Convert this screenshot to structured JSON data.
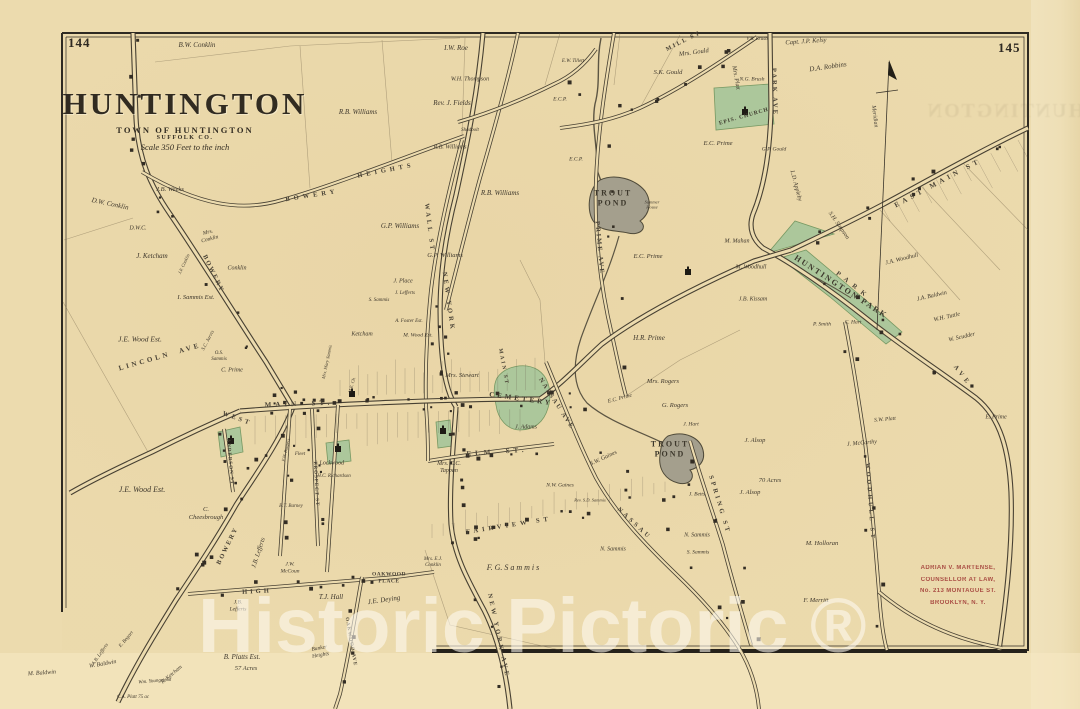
{
  "page": {
    "left_number": "144",
    "right_number": "145"
  },
  "title": {
    "main": "HUNTINGTON",
    "sub1": "TOWN OF HUNTINGTON",
    "sub2": "SUFFOLK CO.",
    "scale": "Scale 350 Feet to the inch"
  },
  "compass": {
    "label": "Meridian"
  },
  "watermark": {
    "text": "Historic Pictoric ®"
  },
  "stamp": {
    "color": "#a3403a",
    "lines": [
      "ADRIAN V. MARTENSE,",
      "COUNSELLOR AT LAW,",
      "No. 213 MONTAGUE ST.",
      "BROOKLYN, N. Y."
    ]
  },
  "colors": {
    "paper": "#ecdbae",
    "ink": "#3f382d",
    "road_casing": "#474032",
    "park_green": "#a9c79b",
    "park_green_edge": "#71955f",
    "pond_gray": "#a49f8d",
    "stream": "#5c5543",
    "stamp_red": "#a3403a"
  },
  "map_labels": {
    "roads": [
      {
        "t": "MAIN  ST.",
        "x": 299,
        "y": 404,
        "r": -2,
        "s": 7,
        "ls": 4
      },
      {
        "t": "MAIN ST",
        "x": 503,
        "y": 367,
        "r": 80,
        "s": 5.5,
        "ls": 2
      },
      {
        "t": "EAST MAIN ST",
        "x": 938,
        "y": 183,
        "r": -28,
        "s": 7,
        "ls": 4
      },
      {
        "t": "ELM  ST.",
        "x": 497,
        "y": 452,
        "r": -4,
        "s": 7,
        "ls": 4
      },
      {
        "t": "WALL ST",
        "x": 429,
        "y": 228,
        "r": 83,
        "s": 6.5,
        "ls": 3
      },
      {
        "t": "NEW YORK",
        "x": 448,
        "y": 302,
        "r": 82,
        "s": 6.5,
        "ls": 3
      },
      {
        "t": "NEW YORK AVE",
        "x": 498,
        "y": 636,
        "r": 78,
        "s": 6.5,
        "ls": 3
      },
      {
        "t": "PRIME AVE",
        "x": 599,
        "y": 248,
        "r": 85,
        "s": 6.5,
        "ls": 2
      },
      {
        "t": "PARK AVE",
        "x": 774,
        "y": 92,
        "r": 88,
        "s": 6.5,
        "ls": 2
      },
      {
        "t": "PARK",
        "x": 853,
        "y": 286,
        "r": 38,
        "s": 6.5,
        "ls": 6
      },
      {
        "t": "AVE",
        "x": 962,
        "y": 376,
        "r": 52,
        "s": 6.5,
        "ls": 4
      },
      {
        "t": "MILL ST",
        "x": 684,
        "y": 42,
        "r": -27,
        "s": 6,
        "ls": 2
      },
      {
        "t": "NASSAU AVE",
        "x": 556,
        "y": 404,
        "r": 57,
        "s": 6.5,
        "ls": 2
      },
      {
        "t": "NASSAU",
        "x": 634,
        "y": 524,
        "r": 43,
        "s": 6.5,
        "ls": 3
      },
      {
        "t": "FAIRVIEW ST",
        "x": 509,
        "y": 526,
        "r": -9,
        "s": 6.5,
        "ls": 4
      },
      {
        "t": "SPRING ST",
        "x": 719,
        "y": 505,
        "r": 73,
        "s": 6.5,
        "ls": 3
      },
      {
        "t": "WOODHULL ST",
        "x": 869,
        "y": 502,
        "r": 86,
        "s": 6,
        "ls": 3
      },
      {
        "t": "HIGH",
        "x": 257,
        "y": 592,
        "r": -3,
        "s": 6.5,
        "ls": 3
      },
      {
        "t": "BOWERY",
        "x": 312,
        "y": 196,
        "r": -9,
        "s": 6.5,
        "ls": 4
      },
      {
        "t": "HEIGHTS",
        "x": 386,
        "y": 171,
        "r": -11,
        "s": 6.5,
        "ls": 4
      },
      {
        "t": "BOWERY",
        "x": 213,
        "y": 274,
        "r": 64,
        "s": 6.5,
        "ls": 2
      },
      {
        "t": "BOWERY",
        "x": 228,
        "y": 546,
        "r": -64,
        "s": 6.5,
        "ls": 2
      },
      {
        "t": "LINCOLN  AVE",
        "x": 160,
        "y": 357,
        "r": -16,
        "s": 7,
        "ls": 3
      },
      {
        "t": "WEST",
        "x": 237,
        "y": 419,
        "r": 20,
        "s": 6.5,
        "ls": 3
      },
      {
        "t": "ANDERSON ST",
        "x": 229,
        "y": 462,
        "r": 85,
        "s": 5,
        "ls": 1
      },
      {
        "t": "PROSPECT ST",
        "x": 315,
        "y": 484,
        "r": 87,
        "s": 5,
        "ls": 1
      },
      {
        "t": "OAKWOOD AVE",
        "x": 350,
        "y": 642,
        "r": 80,
        "s": 5,
        "ls": 1
      },
      {
        "t": "OAKWOOD\nPLACE",
        "x": 389,
        "y": 578,
        "r": 0,
        "s": 5.5,
        "ls": 0.5
      }
    ],
    "features": [
      {
        "t": "TROUT\nPOND",
        "x": 613,
        "y": 198,
        "r": 0,
        "s": 8,
        "ls": 2
      },
      {
        "t": "TROUT\nPOND",
        "x": 670,
        "y": 449,
        "r": 0,
        "s": 8,
        "ls": 2
      },
      {
        "t": "CEMETERY",
        "x": 521,
        "y": 399,
        "r": 8,
        "s": 7,
        "ls": 3
      },
      {
        "t": "EPIS. CHURCH",
        "x": 744,
        "y": 117,
        "r": -16,
        "s": 5.5,
        "ls": 1
      },
      {
        "t": "HUNTINGTON PARK",
        "x": 841,
        "y": 287,
        "r": 33,
        "s": 8,
        "ls": 2
      }
    ],
    "owners": [
      {
        "t": "B.W. Conklin",
        "x": 197,
        "y": 45,
        "r": 0,
        "s": 7
      },
      {
        "t": "I.W. Roe",
        "x": 456,
        "y": 48,
        "r": 0,
        "s": 7
      },
      {
        "t": "W.H. Thompson",
        "x": 470,
        "y": 80,
        "r": 0,
        "s": 6
      },
      {
        "t": "Rev. J. Fields",
        "x": 452,
        "y": 103,
        "r": 0,
        "s": 7
      },
      {
        "t": "Mrs. Gould",
        "x": 694,
        "y": 53,
        "r": -8,
        "s": 6.5
      },
      {
        "t": "S.K. Gould",
        "x": 668,
        "y": 73,
        "r": 0,
        "s": 6.5
      },
      {
        "t": "Capt. J.P. Kelsy",
        "x": 806,
        "y": 42,
        "r": -4,
        "s": 6.5
      },
      {
        "t": "V.B. Brush",
        "x": 757,
        "y": 40,
        "r": 0,
        "s": 5
      },
      {
        "t": "D.A. Robbins",
        "x": 828,
        "y": 67,
        "r": -8,
        "s": 7
      },
      {
        "t": "E.W. Tillett",
        "x": 573,
        "y": 62,
        "r": 0,
        "s": 5
      },
      {
        "t": "N.G. Brush",
        "x": 752,
        "y": 80,
        "r": 0,
        "s": 5.5
      },
      {
        "t": "Mrs. Platt",
        "x": 735,
        "y": 78,
        "r": 80,
        "s": 6
      },
      {
        "t": "E.C. Prime",
        "x": 718,
        "y": 144,
        "r": 0,
        "s": 6.5
      },
      {
        "t": "G.P. Gould",
        "x": 774,
        "y": 150,
        "r": 0,
        "s": 5.5
      },
      {
        "t": "L.D. Appleby",
        "x": 795,
        "y": 186,
        "r": 75,
        "s": 6
      },
      {
        "t": "S.H. Simpson",
        "x": 838,
        "y": 226,
        "r": 55,
        "s": 6
      },
      {
        "t": "E.C.P.",
        "x": 560,
        "y": 100,
        "r": 0,
        "s": 5.5
      },
      {
        "t": "E.C.P.",
        "x": 576,
        "y": 160,
        "r": 0,
        "s": 5.5
      },
      {
        "t": "E.C. Prime",
        "x": 648,
        "y": 257,
        "r": 0,
        "s": 6.5
      },
      {
        "t": "M. Mahan",
        "x": 737,
        "y": 242,
        "r": 0,
        "s": 6
      },
      {
        "t": "M. Woodhull",
        "x": 751,
        "y": 268,
        "r": 0,
        "s": 6
      },
      {
        "t": "J.B. Kissam",
        "x": 753,
        "y": 300,
        "r": 0,
        "s": 6
      },
      {
        "t": "R.B. Williams",
        "x": 358,
        "y": 112,
        "r": 0,
        "s": 7
      },
      {
        "t": "R.B. Williams",
        "x": 450,
        "y": 148,
        "r": 0,
        "s": 6
      },
      {
        "t": "R.B. Williams",
        "x": 500,
        "y": 193,
        "r": 0,
        "s": 7
      },
      {
        "t": "G.P. Williams",
        "x": 400,
        "y": 226,
        "r": 0,
        "s": 7
      },
      {
        "t": "G.P. Williams",
        "x": 445,
        "y": 256,
        "r": 0,
        "s": 6.5
      },
      {
        "t": "Shadbolt",
        "x": 470,
        "y": 131,
        "r": 0,
        "s": 5
      },
      {
        "t": "D.W. Conklin",
        "x": 110,
        "y": 204,
        "r": 12,
        "s": 7
      },
      {
        "t": "J.B. Weeks",
        "x": 170,
        "y": 190,
        "r": 0,
        "s": 6.5
      },
      {
        "t": "D.W.C.",
        "x": 138,
        "y": 229,
        "r": 0,
        "s": 6
      },
      {
        "t": "J. Ketcham",
        "x": 152,
        "y": 256,
        "r": 0,
        "s": 7
      },
      {
        "t": "Mrs.\nConklin",
        "x": 209,
        "y": 236,
        "r": -15,
        "s": 5.5
      },
      {
        "t": "J.F. Conklin",
        "x": 184,
        "y": 264,
        "r": -65,
        "s": 4.5
      },
      {
        "t": "Conklin",
        "x": 237,
        "y": 269,
        "r": 0,
        "s": 6
      },
      {
        "t": "I. Sammis Est.",
        "x": 196,
        "y": 298,
        "r": 0,
        "s": 6.5
      },
      {
        "t": "J.E. Wood Est.",
        "x": 140,
        "y": 339,
        "r": 0,
        "s": 7.5
      },
      {
        "t": "S.C. Jarvis",
        "x": 209,
        "y": 341,
        "r": -62,
        "s": 5
      },
      {
        "t": "O.S.\nSammis",
        "x": 219,
        "y": 357,
        "r": 0,
        "s": 5
      },
      {
        "t": "C. Prime",
        "x": 232,
        "y": 371,
        "r": 0,
        "s": 6
      },
      {
        "t": "J.E. Wood Est.",
        "x": 142,
        "y": 490,
        "r": 0,
        "s": 8
      },
      {
        "t": "C.\nCheesbrough",
        "x": 206,
        "y": 514,
        "r": 0,
        "s": 6.5
      },
      {
        "t": "J.B. Lefferts",
        "x": 259,
        "y": 553,
        "r": -72,
        "s": 6.5
      },
      {
        "t": "J.W.\nMcCoun",
        "x": 290,
        "y": 568,
        "r": 0,
        "s": 5.5
      },
      {
        "t": "Wm. Youngstead",
        "x": 155,
        "y": 682,
        "r": -5,
        "s": 5
      },
      {
        "t": "W. Baldwin",
        "x": 103,
        "y": 665,
        "r": -10,
        "s": 6
      },
      {
        "t": "M. Baldwin",
        "x": 42,
        "y": 674,
        "r": -4,
        "s": 6
      },
      {
        "t": "R. Ketcham",
        "x": 172,
        "y": 675,
        "r": -40,
        "s": 5.5
      },
      {
        "t": "E. Bogart",
        "x": 127,
        "y": 640,
        "r": -50,
        "s": 5
      },
      {
        "t": "A.B. Lefferts",
        "x": 101,
        "y": 655,
        "r": -55,
        "s": 5
      },
      {
        "t": "B. Platts Est.",
        "x": 242,
        "y": 657,
        "r": 0,
        "s": 7
      },
      {
        "t": "C.A. Platt 75 ac",
        "x": 133,
        "y": 698,
        "r": 0,
        "s": 5
      },
      {
        "t": "T.J. Hall",
        "x": 331,
        "y": 597,
        "r": 0,
        "s": 7
      },
      {
        "t": "J.E. Deying",
        "x": 384,
        "y": 600,
        "r": -8,
        "s": 7
      },
      {
        "t": "Bunker\nHeights",
        "x": 320,
        "y": 652,
        "r": -10,
        "s": 5.5
      },
      {
        "t": "J.B.\nLefferts",
        "x": 238,
        "y": 606,
        "r": 0,
        "s": 5.5
      },
      {
        "t": "Mrs. Mary Sammis",
        "x": 327,
        "y": 362,
        "r": -78,
        "s": 4.5
      },
      {
        "t": "M.E. Ch.",
        "x": 352,
        "y": 385,
        "r": -75,
        "s": 4.5
      },
      {
        "t": "Ketcham",
        "x": 362,
        "y": 335,
        "r": 0,
        "s": 6
      },
      {
        "t": "M. Wood Est.",
        "x": 418,
        "y": 336,
        "r": 0,
        "s": 5.5
      },
      {
        "t": "J. Place",
        "x": 403,
        "y": 282,
        "r": 0,
        "s": 6
      },
      {
        "t": "J. Lefferts",
        "x": 405,
        "y": 294,
        "r": 0,
        "s": 5
      },
      {
        "t": "S. Sammis",
        "x": 379,
        "y": 301,
        "r": 0,
        "s": 5
      },
      {
        "t": "A. Foster Est.",
        "x": 409,
        "y": 322,
        "r": 0,
        "s": 5
      },
      {
        "t": "Fleet",
        "x": 300,
        "y": 455,
        "r": 0,
        "s": 5
      },
      {
        "t": "F.W. Burgess",
        "x": 286,
        "y": 450,
        "r": -76,
        "s": 4.5
      },
      {
        "t": "J. Lockwood",
        "x": 329,
        "y": 464,
        "r": 0,
        "s": 6
      },
      {
        "t": "H.C. Richardson",
        "x": 334,
        "y": 477,
        "r": 0,
        "s": 5
      },
      {
        "t": "B.T. Barney",
        "x": 291,
        "y": 507,
        "r": 0,
        "s": 5
      },
      {
        "t": "Mrs. Stewart",
        "x": 462,
        "y": 376,
        "r": 0,
        "s": 6.5
      },
      {
        "t": "J. Adams",
        "x": 526,
        "y": 428,
        "r": 0,
        "s": 6
      },
      {
        "t": "Mrs. C.C.\nTappan",
        "x": 449,
        "y": 468,
        "r": 0,
        "s": 6
      },
      {
        "t": "S.W. Gaines",
        "x": 604,
        "y": 459,
        "r": -25,
        "s": 6
      },
      {
        "t": "N.W. Gaines",
        "x": 560,
        "y": 486,
        "r": 0,
        "s": 5.5
      },
      {
        "t": "Rev. S.D. Sammis",
        "x": 590,
        "y": 500,
        "r": 0,
        "s": 4.5
      },
      {
        "t": "F. G. S a m m i s",
        "x": 513,
        "y": 568,
        "r": 0,
        "s": 8
      },
      {
        "t": "N. Sammis",
        "x": 613,
        "y": 550,
        "r": 0,
        "s": 6
      },
      {
        "t": "N. Sammis",
        "x": 697,
        "y": 536,
        "r": 0,
        "s": 6
      },
      {
        "t": "S. Sammis",
        "x": 698,
        "y": 553,
        "r": 0,
        "s": 5.5
      },
      {
        "t": "J. Betts",
        "x": 697,
        "y": 495,
        "r": 0,
        "s": 5.5
      },
      {
        "t": "J. Hart",
        "x": 691,
        "y": 425,
        "r": 0,
        "s": 5.5
      },
      {
        "t": "H.R. Prime",
        "x": 649,
        "y": 338,
        "r": 0,
        "s": 7
      },
      {
        "t": "Mrs. Rogers",
        "x": 663,
        "y": 382,
        "r": 0,
        "s": 6.5
      },
      {
        "t": "G. Rogers",
        "x": 675,
        "y": 406,
        "r": 0,
        "s": 6.5
      },
      {
        "t": "E.C. Prime",
        "x": 620,
        "y": 399,
        "r": -15,
        "s": 5.5
      },
      {
        "t": "J. Alsop",
        "x": 755,
        "y": 441,
        "r": 0,
        "s": 6.5
      },
      {
        "t": "J. Alsop",
        "x": 750,
        "y": 493,
        "r": 0,
        "s": 6.5
      },
      {
        "t": "M. Holloran",
        "x": 822,
        "y": 544,
        "r": 0,
        "s": 6.5
      },
      {
        "t": "F. Merritt",
        "x": 816,
        "y": 601,
        "r": 0,
        "s": 6.5
      },
      {
        "t": "J. McCarthy",
        "x": 862,
        "y": 444,
        "r": -5,
        "s": 6
      },
      {
        "t": "S.W. Platt",
        "x": 885,
        "y": 420,
        "r": -5,
        "s": 5.5
      },
      {
        "t": "J.A. Woodhull",
        "x": 902,
        "y": 260,
        "r": -14,
        "s": 6
      },
      {
        "t": "J.A. Baldwin",
        "x": 932,
        "y": 297,
        "r": -13,
        "s": 6
      },
      {
        "t": "W.H. Tuttle",
        "x": 947,
        "y": 318,
        "r": -13,
        "s": 6
      },
      {
        "t": "W. Scudder",
        "x": 962,
        "y": 338,
        "r": -13,
        "s": 6
      },
      {
        "t": "E. Prime",
        "x": 996,
        "y": 418,
        "r": 0,
        "s": 6
      },
      {
        "t": "P. Smith",
        "x": 822,
        "y": 325,
        "r": 0,
        "s": 5.5
      },
      {
        "t": "C. Hart",
        "x": 853,
        "y": 323,
        "r": 0,
        "s": 5.5
      },
      {
        "t": "Mrs. E.J.\nConklin",
        "x": 433,
        "y": 563,
        "r": 0,
        "s": 5
      },
      {
        "t": "Summer\nHouse",
        "x": 652,
        "y": 205,
        "r": 0,
        "s": 4.5
      },
      {
        "t": "Mrs. Stewart",
        "x": -100,
        "y": -100,
        "r": 0,
        "s": 5
      }
    ],
    "acreage": [
      {
        "t": "57 Acres",
        "x": 246,
        "y": 669,
        "r": 0,
        "s": 6.5
      },
      {
        "t": "70 Acres",
        "x": 770,
        "y": 481,
        "r": 0,
        "s": 6.5
      }
    ]
  }
}
